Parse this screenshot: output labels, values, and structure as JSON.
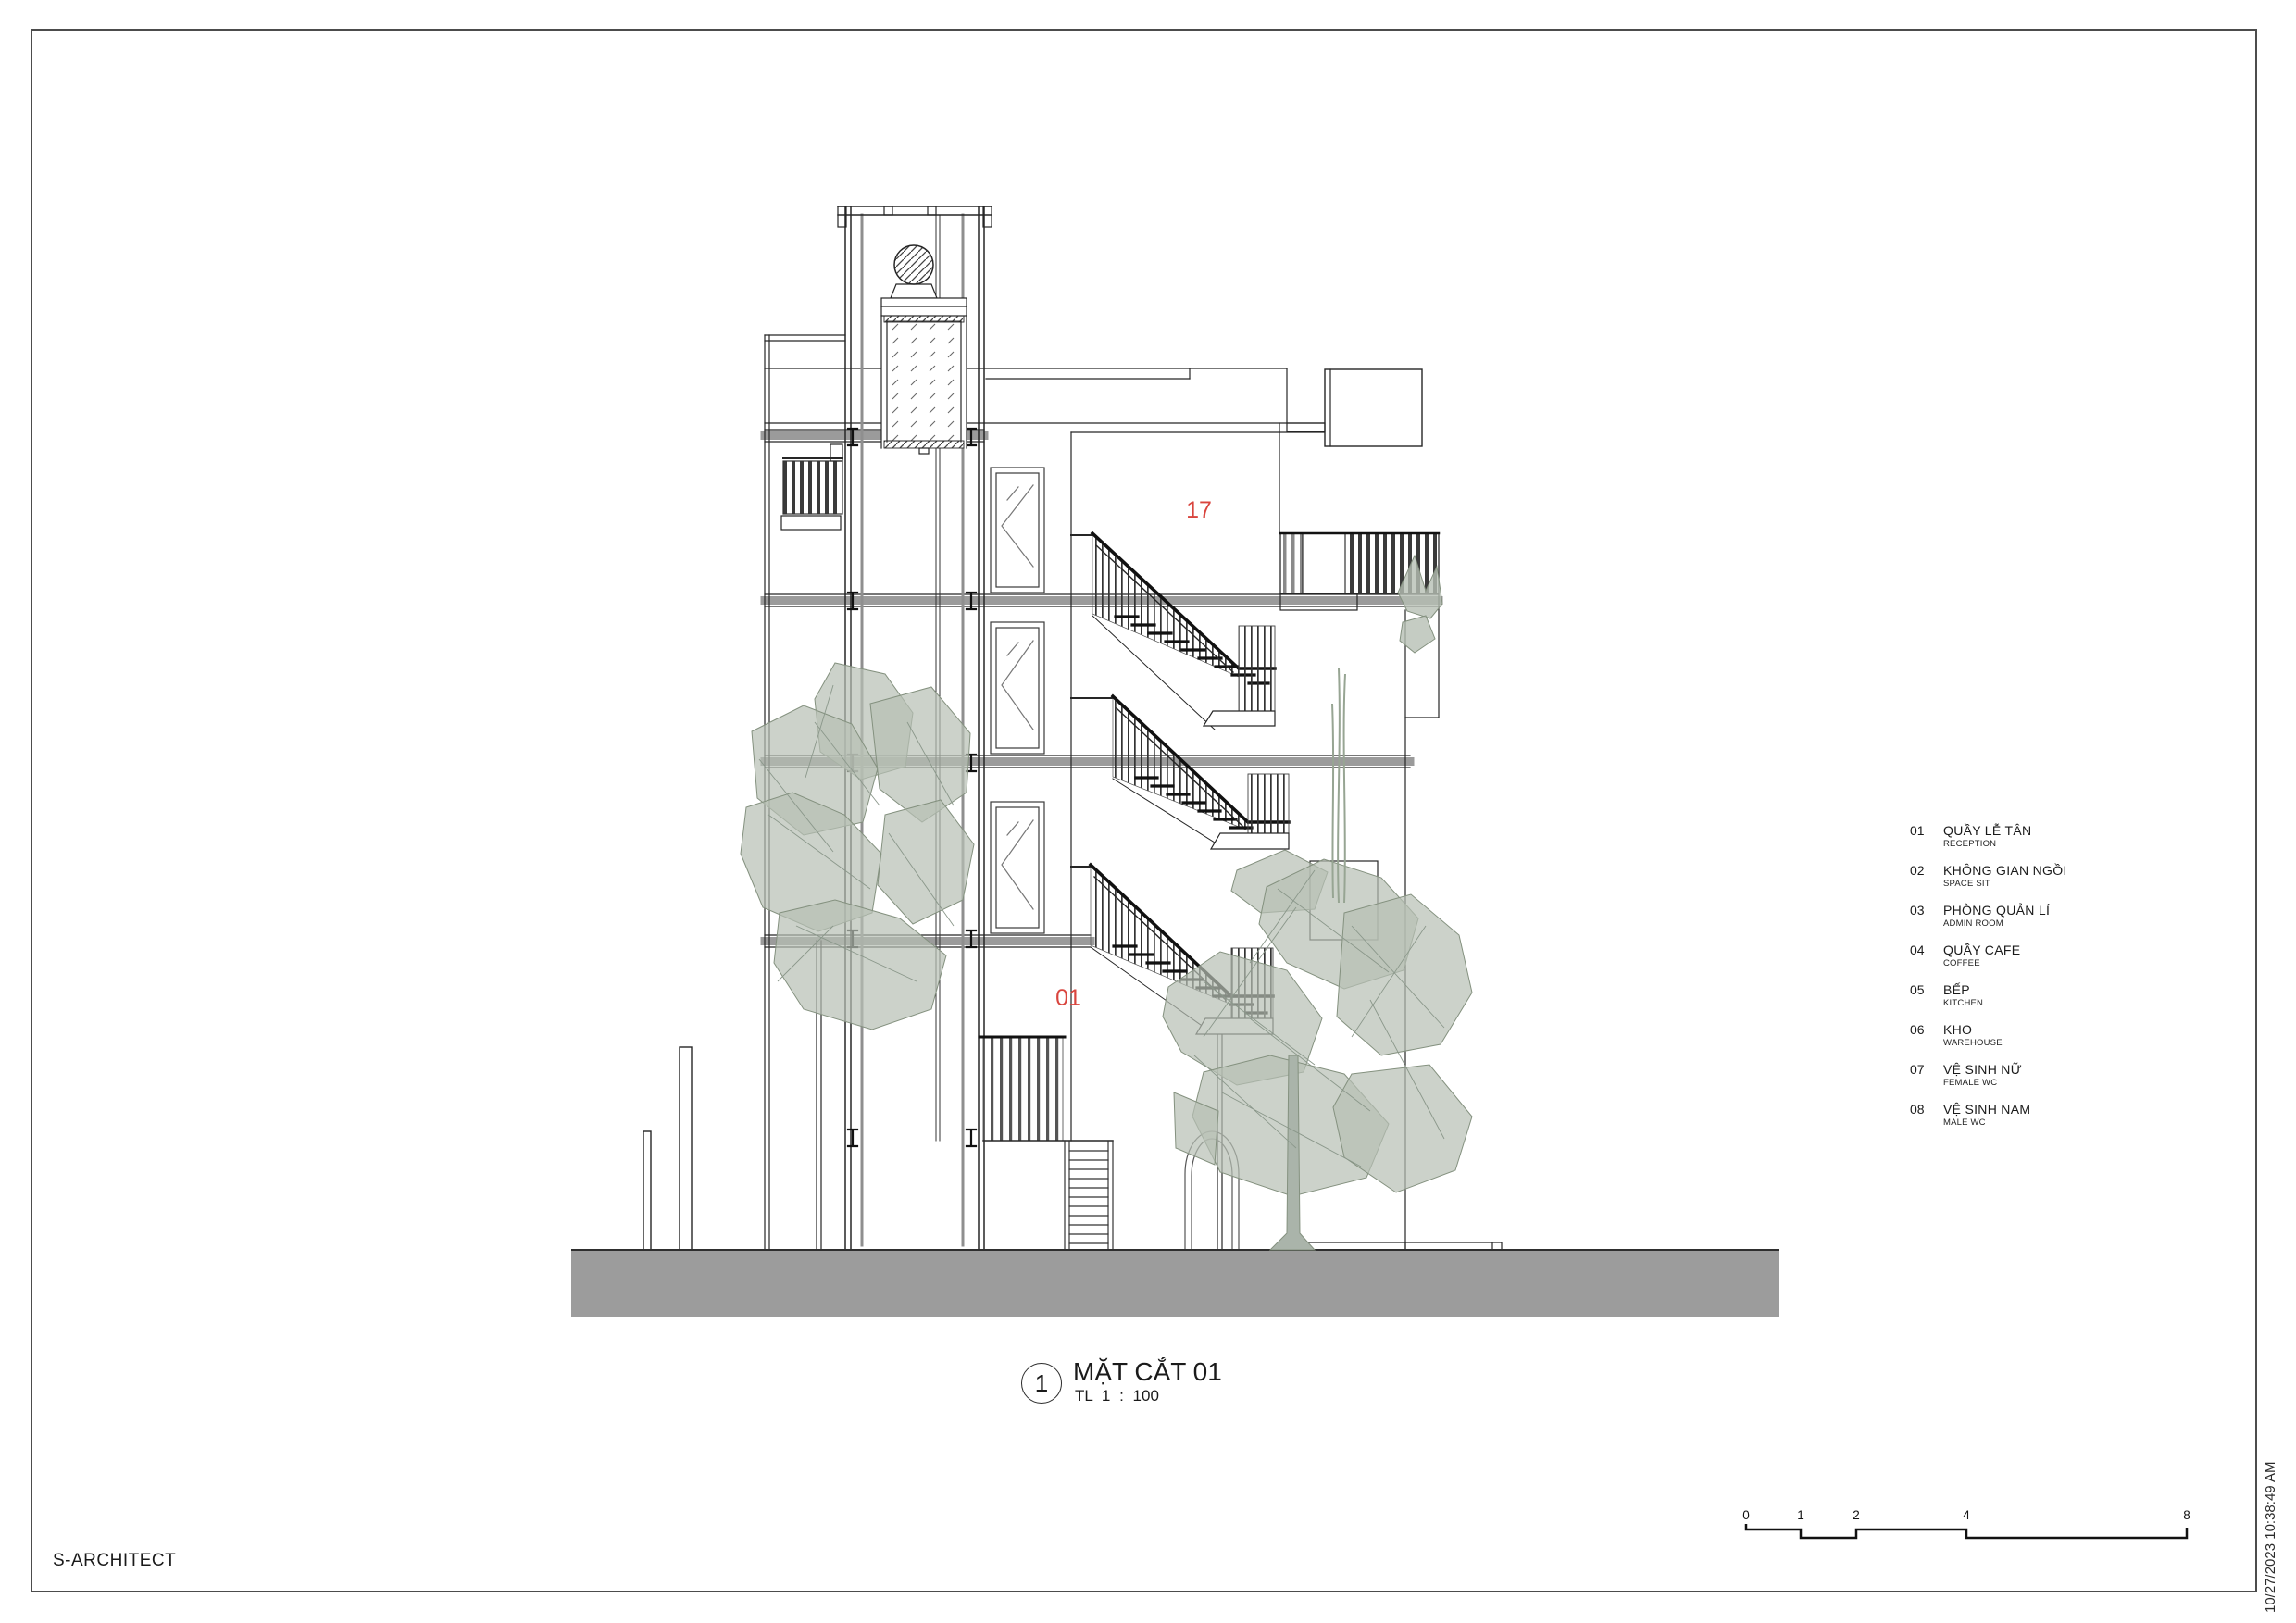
{
  "sheet": {
    "firm_name": "S-ARCHITECT",
    "print_timestamp": "10/27/2023 10:38:49 AM"
  },
  "title_block": {
    "view_number": "1",
    "view_title": "MẶT CẮT 01",
    "scale_label": "TL 1 : 100"
  },
  "drawing_labels": {
    "upper_floor_tag": "17",
    "ground_floor_tag": "01"
  },
  "legend": {
    "items": [
      {
        "num": "01",
        "vi": "QUẦY LỄ TÂN",
        "en": "RECEPTION"
      },
      {
        "num": "02",
        "vi": "KHÔNG GIAN NGỒI",
        "en": "SPACE SIT"
      },
      {
        "num": "03",
        "vi": "PHÒNG QUẢN LÍ",
        "en": "ADMIN ROOM"
      },
      {
        "num": "04",
        "vi": "QUẦY CAFE",
        "en": "COFFEE"
      },
      {
        "num": "05",
        "vi": "BẾP",
        "en": "KITCHEN"
      },
      {
        "num": "06",
        "vi": "KHO",
        "en": "WAREHOUSE"
      },
      {
        "num": "07",
        "vi": "VỆ SINH NỮ",
        "en": "FEMALE WC"
      },
      {
        "num": "08",
        "vi": "VỆ SINH NAM",
        "en": "MALE WC"
      }
    ]
  },
  "scale_bar": {
    "ticks": [
      "0",
      "1",
      "2",
      "4",
      "8"
    ]
  },
  "colors": {
    "tag_red": "#d9453e",
    "ground_gray": "#9c9c9c",
    "tree_green": "#b7bfb4",
    "slab_gray": "#9b9b9b"
  }
}
